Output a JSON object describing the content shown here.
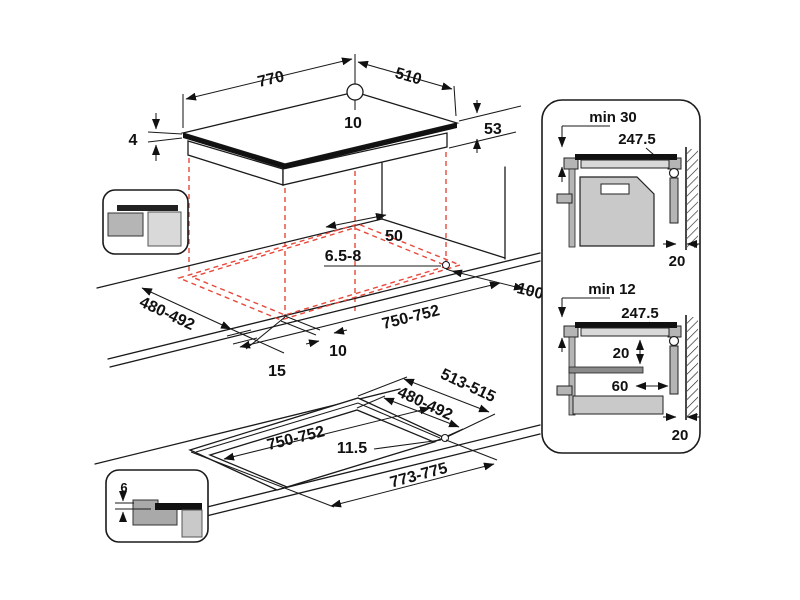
{
  "title": "Hob built-in installation dimensions diagram",
  "colors": {
    "line": "#1a1a1a",
    "projection_red": "#e8483b",
    "gray_light": "#d9d9d9",
    "gray_mid": "#b5b5b5",
    "gray_cabinet": "#c9c9c9",
    "gray_dark": "#8a8a8a"
  },
  "top_view": {
    "width_mm": "770",
    "depth_mm": "510",
    "center_mark_mm": "10",
    "glass_thickness_mm": "4",
    "body_height_mm": "53"
  },
  "cutout_view": {
    "back_clearance_mm": "50",
    "corner_radius_mm": "6.5-8",
    "side_clearance_mm": "100",
    "cutout_depth_mm": "480-492",
    "cutout_width_mm": "750-752",
    "front_inset_mm": "10",
    "front_clearance_mm": "15"
  },
  "flush_view": {
    "step_depth_mm": "513-515",
    "cutout_depth_mm": "480-492",
    "cutout_width_mm": "750-752",
    "step_offset_mm": "11.5",
    "step_width_mm": "773-775",
    "recess_height_mm": "6"
  },
  "clearance_top": {
    "min_thickness": "min 30",
    "center_distance": "247.5",
    "wall_gap": "20"
  },
  "clearance_bottom": {
    "min_thickness": "min 12",
    "center_distance": "247.5",
    "hob_shelf_gap": "20",
    "shelf_wall_gap": "60",
    "wall_gap": "20"
  }
}
